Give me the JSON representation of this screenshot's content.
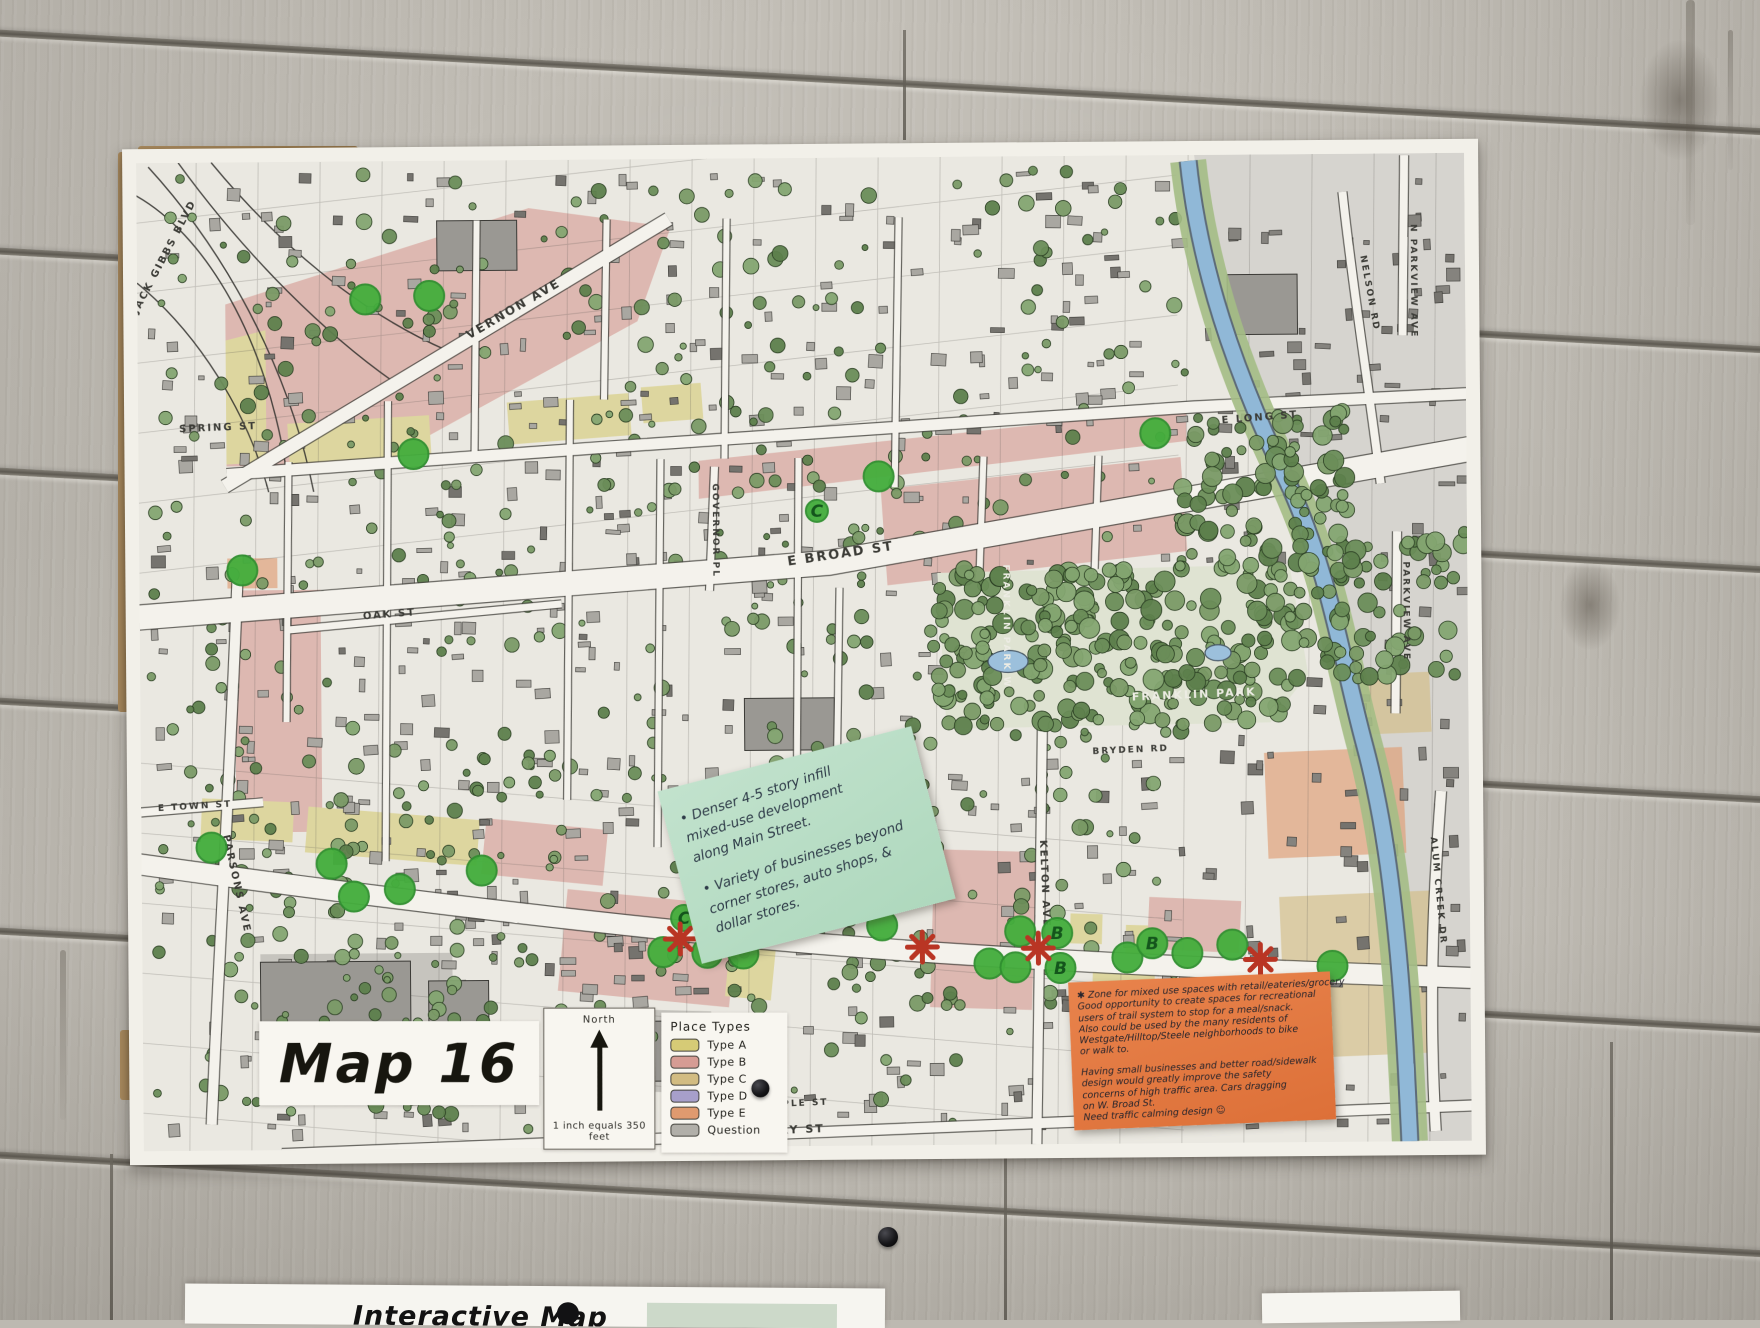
{
  "poster": {
    "title": "Map 16",
    "north_label": "North",
    "scale_text": "1 inch equals 350 feet",
    "legend": {
      "title": "Place Types",
      "items": [
        {
          "label": "Type A",
          "color": "#d6cb76"
        },
        {
          "label": "Type B",
          "color": "#d69c94"
        },
        {
          "label": "Type C",
          "color": "#d2bc82"
        },
        {
          "label": "Type D",
          "color": "#a79fca"
        },
        {
          "label": "Type E",
          "color": "#df9a6f"
        },
        {
          "label": "Question",
          "color": "#b1afa9"
        }
      ]
    },
    "streets": [
      {
        "name": "JACK GIBBS BLVD",
        "x": 30,
        "y": 95,
        "rot": -62,
        "size": 10
      },
      {
        "name": "SPRING ST",
        "x": 80,
        "y": 268,
        "rot": -2,
        "size": 10
      },
      {
        "name": "VERNON AVE",
        "x": 378,
        "y": 152,
        "rot": -30,
        "size": 12
      },
      {
        "name": "E LONG ST",
        "x": 1122,
        "y": 266,
        "rot": -4,
        "size": 10
      },
      {
        "name": "E BROAD ST",
        "x": 702,
        "y": 400,
        "rot": -8,
        "size": 13
      },
      {
        "name": "OAK ST",
        "x": 250,
        "y": 456,
        "rot": -4,
        "size": 10
      },
      {
        "name": "GOVERNOR PL",
        "x": 574,
        "y": 372,
        "rot": 90,
        "size": 9
      },
      {
        "name": "E TOWN ST",
        "x": 54,
        "y": 646,
        "rot": -3,
        "size": 9
      },
      {
        "name": "PARSONS AVE",
        "x": 92,
        "y": 722,
        "rot": 78,
        "size": 10
      },
      {
        "name": "FRANKLIN PARK W",
        "x": 864,
        "y": 470,
        "rot": 90,
        "size": 9,
        "light": true
      },
      {
        "name": "FRANKLIN PARK",
        "x": 1054,
        "y": 543,
        "rot": -2,
        "size": 11,
        "light": true
      },
      {
        "name": "BRYDEN RD",
        "x": 990,
        "y": 597,
        "rot": -2,
        "size": 9
      },
      {
        "name": "E MAIN ST",
        "x": 602,
        "y": 766,
        "rot": 7,
        "size": 12
      },
      {
        "name": "KELTON AVE",
        "x": 900,
        "y": 728,
        "rot": 88,
        "size": 10
      },
      {
        "name": "MULBERRY ST",
        "x": 627,
        "y": 976,
        "rot": -2,
        "size": 11
      },
      {
        "name": "MAPLE ST",
        "x": 652,
        "y": 948,
        "rot": -2,
        "size": 9
      },
      {
        "name": "NELSON RD",
        "x": 1230,
        "y": 140,
        "rot": 80,
        "size": 9
      },
      {
        "name": "N PARKVIEW AVE",
        "x": 1274,
        "y": 128,
        "rot": 90,
        "size": 9
      },
      {
        "name": "PARKVIEW AVE",
        "x": 1264,
        "y": 458,
        "rot": 90,
        "size": 9
      },
      {
        "name": "ALUM CREEK DR",
        "x": 1294,
        "y": 738,
        "rot": 85,
        "size": 9
      }
    ],
    "notes": {
      "green": {
        "color": "#b8dcc6",
        "lines": [
          "• Denser 4-5 story infill",
          "  mixed-use development",
          "  along Main Street.",
          "",
          "• Variety of businesses beyond",
          "  corner stores, auto shops, &",
          "  dollar stores."
        ]
      },
      "orange": {
        "color": "#e2773f",
        "lines": [
          "✱ Zone for mixed use spaces with retail/eateries/grocery",
          "Good opportunity to create spaces for recreational",
          "users of trail system to stop for a meal/snack.",
          "Also could be used by the many residents of",
          "Westgate/Hilltop/Steele neighborhoods to bike",
          "or walk to.",
          "",
          "Having small businesses and better road/sidewalk",
          "design would greatly improve the safety",
          "concerns of high traffic area. Cars dragging",
          "on W. Broad St.",
          "Need traffic calming design ☺"
        ]
      }
    },
    "markers": {
      "sticker_color": "#43ad3c",
      "asterisk_color": "#b93524",
      "green_dots": [
        [
          228,
          138
        ],
        [
          292,
          135
        ],
        [
          275,
          293
        ],
        [
          103,
          408
        ],
        [
          740,
          319
        ],
        [
          1017,
          278
        ],
        [
          70,
          685
        ],
        [
          190,
          702
        ],
        [
          212,
          735
        ],
        [
          258,
          728
        ],
        [
          340,
          710
        ],
        [
          582,
          763
        ],
        [
          650,
          765
        ],
        [
          521,
          793
        ],
        [
          565,
          794
        ],
        [
          601,
          795
        ],
        [
          740,
          768
        ],
        [
          878,
          775
        ],
        [
          847,
          807
        ],
        [
          873,
          811
        ],
        [
          1045,
          798
        ],
        [
          1090,
          790
        ],
        [
          985,
          802
        ],
        [
          1190,
          812
        ]
      ],
      "letter_dots": [
        {
          "letter": "C",
          "x": 678,
          "y": 353,
          "r": 11
        },
        {
          "letter": "C",
          "x": 542,
          "y": 759,
          "r": 13
        },
        {
          "letter": "B",
          "x": 915,
          "y": 777,
          "r": 15
        },
        {
          "letter": "B",
          "x": 918,
          "y": 812,
          "r": 15
        },
        {
          "letter": "B",
          "x": 1010,
          "y": 788,
          "r": 15
        }
      ],
      "asterisks": [
        [
          538,
          780
        ],
        [
          780,
          790
        ],
        [
          896,
          792
        ],
        [
          1118,
          805
        ]
      ]
    },
    "colors": {
      "river": "#90b8d7",
      "map_paper": "#eae8e1",
      "road": "#f4f2ec"
    }
  },
  "bottom": {
    "paper1_text": "Interactive Map"
  }
}
